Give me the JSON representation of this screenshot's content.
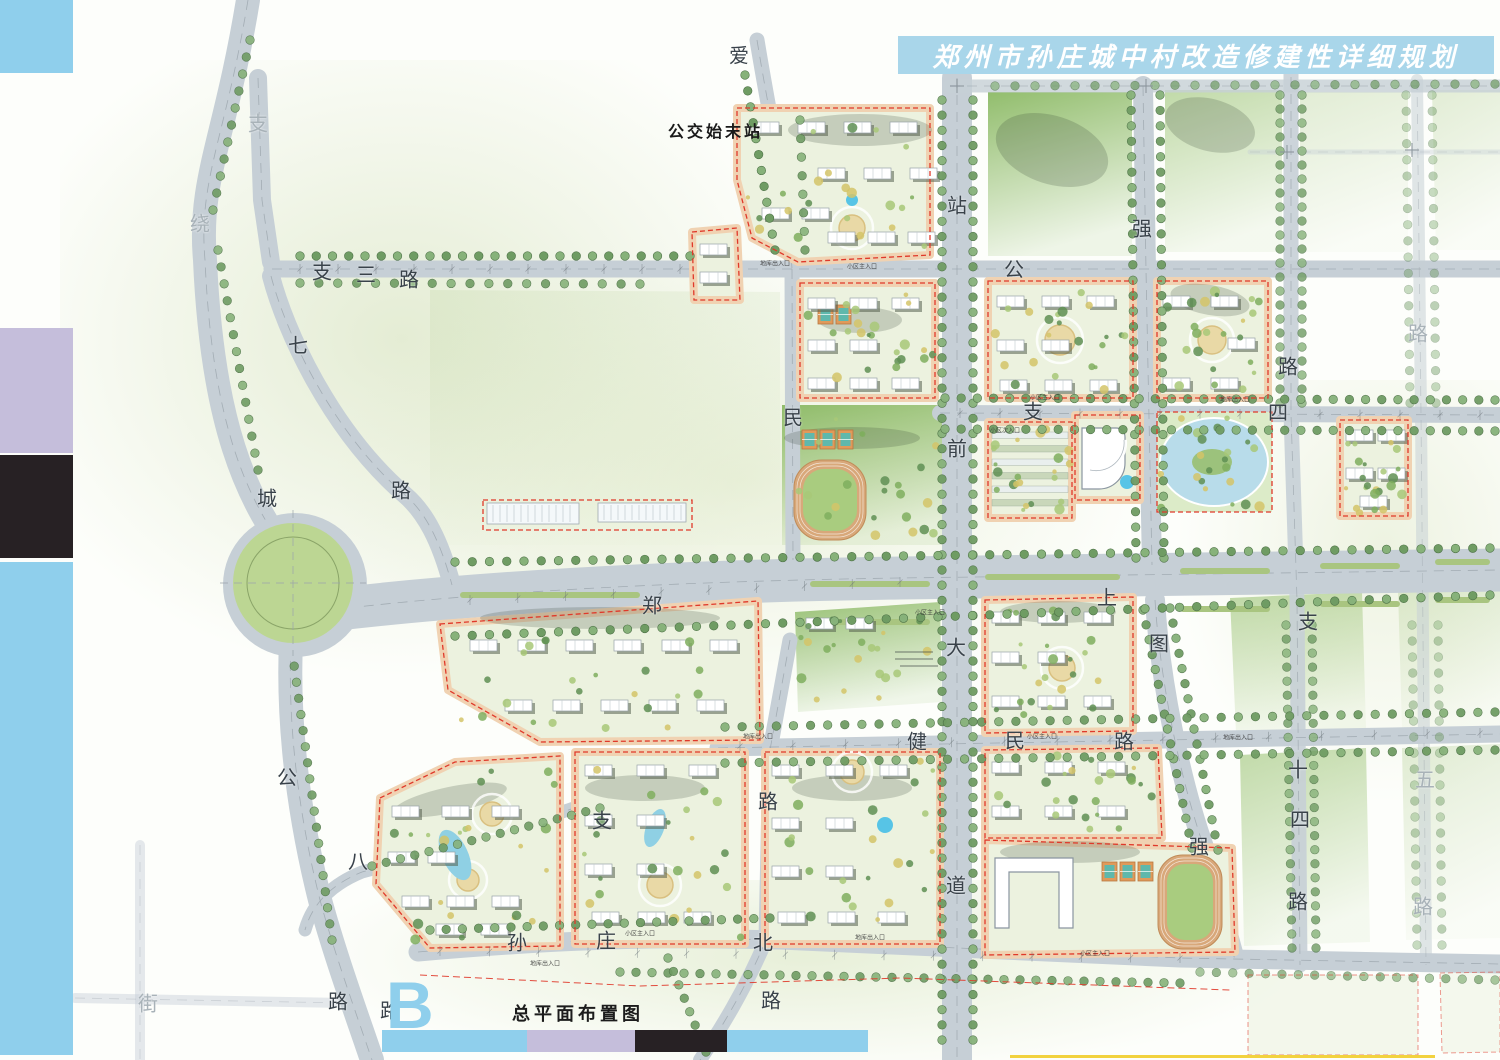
{
  "header": {
    "title": "郑州市孙庄城中村改造修建性详细规划"
  },
  "footer": {
    "plan_letter": "B",
    "caption": "总平面布置图"
  },
  "map": {
    "bus_terminal_label": "公交始末站",
    "road_labels": [
      {
        "text": "支",
        "x": 258,
        "y": 122,
        "tone": "faint"
      },
      {
        "text": "绕",
        "x": 200,
        "y": 222,
        "tone": "faint"
      },
      {
        "text": "支",
        "x": 322,
        "y": 270,
        "tone": "dark"
      },
      {
        "text": "三",
        "x": 366,
        "y": 273,
        "tone": "dark"
      },
      {
        "text": "路",
        "x": 409,
        "y": 278,
        "tone": "dark"
      },
      {
        "text": "七",
        "x": 298,
        "y": 344,
        "tone": "dark"
      },
      {
        "text": "路",
        "x": 401,
        "y": 489,
        "tone": "dark"
      },
      {
        "text": "城",
        "x": 267,
        "y": 497,
        "tone": "dark"
      },
      {
        "text": "公",
        "x": 287,
        "y": 776,
        "tone": "dark"
      },
      {
        "text": "路",
        "x": 338,
        "y": 1000,
        "tone": "dark"
      },
      {
        "text": "路",
        "x": 390,
        "y": 1009,
        "tone": "dark"
      },
      {
        "text": "街",
        "x": 148,
        "y": 1002,
        "tone": "faint"
      },
      {
        "text": "爱",
        "x": 739,
        "y": 54,
        "tone": "dark"
      },
      {
        "text": "民",
        "x": 793,
        "y": 416,
        "tone": "dark"
      },
      {
        "text": "路",
        "x": 768,
        "y": 800,
        "tone": "dark"
      },
      {
        "text": "站",
        "x": 957,
        "y": 204,
        "tone": "dark"
      },
      {
        "text": "前",
        "x": 957,
        "y": 447,
        "tone": "dark"
      },
      {
        "text": "大",
        "x": 956,
        "y": 646,
        "tone": "dark"
      },
      {
        "text": "道",
        "x": 956,
        "y": 884,
        "tone": "dark"
      },
      {
        "text": "公",
        "x": 1014,
        "y": 268,
        "tone": "dark"
      },
      {
        "text": "强",
        "x": 1142,
        "y": 227,
        "tone": "dark"
      },
      {
        "text": "图",
        "x": 1159,
        "y": 642,
        "tone": "dark"
      },
      {
        "text": "强",
        "x": 1199,
        "y": 845,
        "tone": "dark"
      },
      {
        "text": "支",
        "x": 1033,
        "y": 410,
        "tone": "dark"
      },
      {
        "text": "四",
        "x": 1278,
        "y": 411,
        "tone": "dark"
      },
      {
        "text": "郑",
        "x": 652,
        "y": 604,
        "tone": "dark"
      },
      {
        "text": "上",
        "x": 1107,
        "y": 596,
        "tone": "dark"
      },
      {
        "text": "健",
        "x": 917,
        "y": 740,
        "tone": "dark"
      },
      {
        "text": "民",
        "x": 1015,
        "y": 739,
        "tone": "dark"
      },
      {
        "text": "路",
        "x": 1124,
        "y": 740,
        "tone": "dark"
      },
      {
        "text": "支",
        "x": 1308,
        "y": 620,
        "tone": "dark"
      },
      {
        "text": "十",
        "x": 1298,
        "y": 768,
        "tone": "dark"
      },
      {
        "text": "四",
        "x": 1300,
        "y": 818,
        "tone": "dark"
      },
      {
        "text": "路",
        "x": 1298,
        "y": 900,
        "tone": "dark"
      },
      {
        "text": "五",
        "x": 1425,
        "y": 778,
        "tone": "faint"
      },
      {
        "text": "路",
        "x": 1423,
        "y": 905,
        "tone": "faint"
      },
      {
        "text": "路",
        "x": 1288,
        "y": 365,
        "tone": "dark"
      },
      {
        "text": "路",
        "x": 1418,
        "y": 332,
        "tone": "faint"
      },
      {
        "text": "支",
        "x": 602,
        "y": 819,
        "tone": "dark"
      },
      {
        "text": "八",
        "x": 358,
        "y": 860,
        "tone": "dark"
      },
      {
        "text": "孙",
        "x": 517,
        "y": 941,
        "tone": "dark"
      },
      {
        "text": "庄",
        "x": 606,
        "y": 939,
        "tone": "dark"
      },
      {
        "text": "北",
        "x": 763,
        "y": 941,
        "tone": "dark"
      },
      {
        "text": "路",
        "x": 771,
        "y": 999,
        "tone": "dark"
      }
    ],
    "entrance_labels": [
      {
        "text": "地库出入口",
        "x": 775,
        "y": 263
      },
      {
        "text": "小区主入口",
        "x": 862,
        "y": 266
      },
      {
        "text": "小区主入口",
        "x": 1045,
        "y": 397
      },
      {
        "text": "地库出入口",
        "x": 1235,
        "y": 399
      },
      {
        "text": "小区主入口",
        "x": 930,
        "y": 612
      },
      {
        "text": "地库出入口",
        "x": 758,
        "y": 736
      },
      {
        "text": "小区主入口",
        "x": 1042,
        "y": 736
      },
      {
        "text": "地库出入口",
        "x": 1238,
        "y": 737
      },
      {
        "text": "小区主入口",
        "x": 640,
        "y": 933
      },
      {
        "text": "地库出入口",
        "x": 870,
        "y": 937
      },
      {
        "text": "小区主入口",
        "x": 1095,
        "y": 953
      },
      {
        "text": "地库出入口",
        "x": 545,
        "y": 963
      },
      {
        "text": "小区次入口",
        "x": 1005,
        "y": 430
      }
    ]
  },
  "colors": {
    "banner_bg": "#a9d6ea",
    "bar_blue": "#8fcfec",
    "bar_lavender": "#c5bedb",
    "bar_black": "#272124",
    "road": "#c6cfd6",
    "tree": "#6f9c63",
    "block_edge": "#f0d2b2",
    "block_inner": "#ecf2df",
    "water": "#b8dcea",
    "track": "#d8a87a",
    "red_dash": "#e0392a",
    "yellow_line": "#f2d23e"
  }
}
